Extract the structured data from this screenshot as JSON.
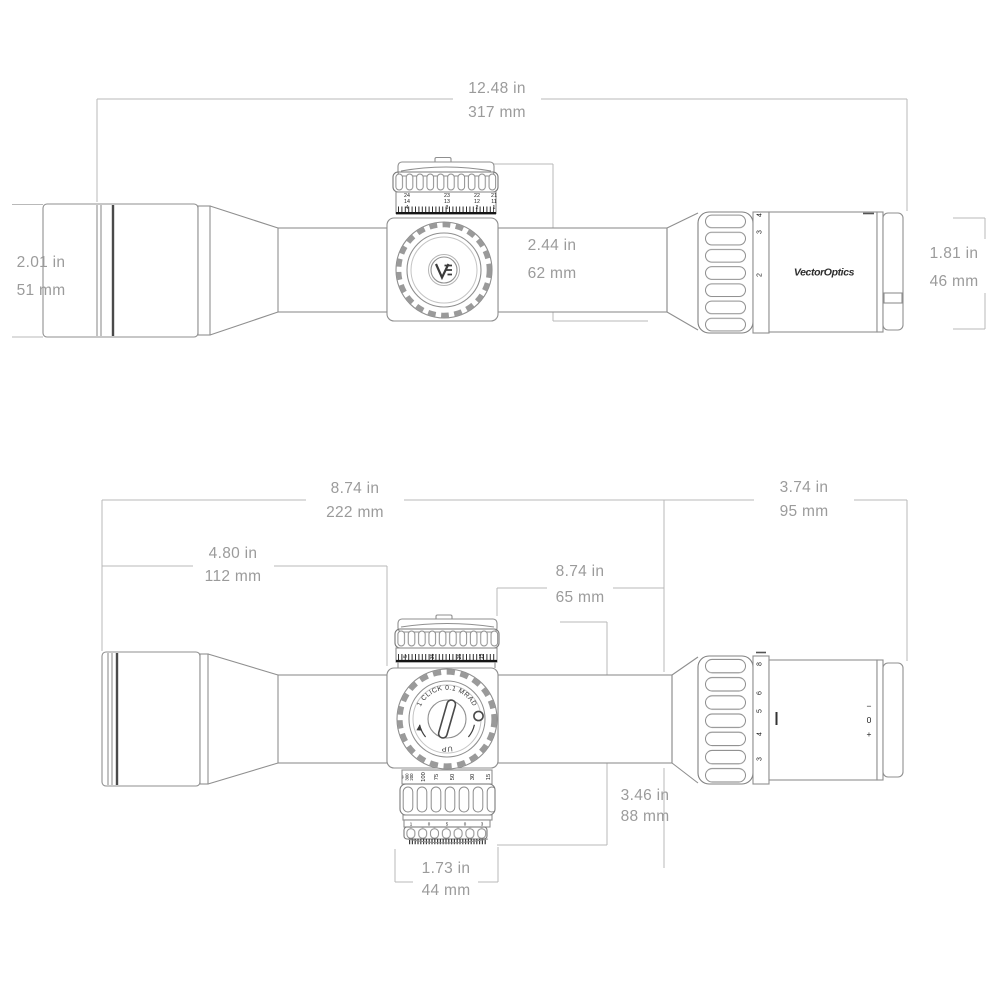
{
  "title": "Riflescope dimensions technical drawing",
  "colors": {
    "background": "#ffffff",
    "dimension_line": "#b9b9b9",
    "dimension_text": "#9b9b9b",
    "body_line": "#8f8f8f",
    "dark_marks": "#222222"
  },
  "top_view": {
    "dim_overall_length": {
      "in_label": "12.48 in",
      "mm_label": "317 mm"
    },
    "dim_objective_diameter": {
      "in_label": "2.01 in",
      "mm_label": "51 mm"
    },
    "dim_turret_height": {
      "in_label": "2.44 in",
      "mm_label": "62 mm"
    },
    "dim_eyepiece_diameter": {
      "in_label": "1.81 in",
      "mm_label": "46 mm"
    },
    "turret_columns": [
      [
        "24",
        "14",
        "4"
      ],
      [
        "23",
        "13",
        "3"
      ],
      [
        "22",
        "12",
        "2"
      ],
      [
        "21",
        "11",
        "1"
      ]
    ],
    "zoom_numbers": [
      "4",
      "3",
      "2"
    ],
    "brand_label": "VectorOptics"
  },
  "bottom_view": {
    "dim_front_length": {
      "in_label": "8.74 in",
      "mm_label": "222 mm"
    },
    "dim_eyepiece_length": {
      "in_label": "3.74 in",
      "mm_label": "95 mm"
    },
    "dim_objective_to_turret": {
      "in_label": "4.80 in",
      "mm_label": "112 mm"
    },
    "dim_saddle_length": {
      "in_label": "8.74 in",
      "mm_label": "65 mm"
    },
    "dim_turret_height": {
      "in_label": "3.46 in",
      "mm_label": "88 mm"
    },
    "dim_turret_width": {
      "in_label": "1.73 in",
      "mm_label": "44 mm"
    },
    "knob": {
      "click_label": "1 CLICK 0.1 MRAD",
      "up_label": "UP"
    },
    "turret_scale_numbers": [
      "5",
      "35",
      "25",
      "15"
    ],
    "parallax_numbers": [
      "∞",
      "300",
      "200",
      "100",
      "75",
      "50",
      "30",
      "15"
    ],
    "illumination_marks": [
      "1",
      "0",
      "5",
      "0",
      "3"
    ],
    "zoom_numbers": [
      "8",
      "6",
      "5",
      "4",
      "3"
    ],
    "diopter_marks": [
      "−",
      "0",
      "+"
    ]
  }
}
